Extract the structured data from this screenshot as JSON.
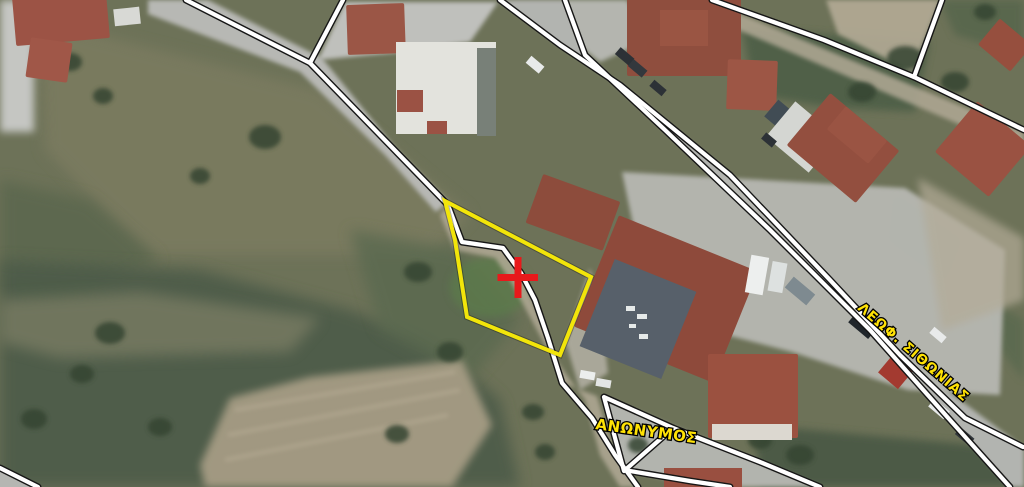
{
  "map": {
    "streets": [
      {
        "name": "ΑΝΩΝΥΜΟΣ",
        "transform": "translate(595,429) rotate(8)"
      },
      {
        "name": "ΛΕΩΦ. ΣΙΘΩΝΙΑΣ",
        "transform": "translate(857,309) rotate(41)"
      }
    ],
    "parcel": {
      "points": "445,201 591,277 560,355 467,317 455,240",
      "outline_color": "#F2E50A"
    },
    "marker": {
      "path": "M497.5,277.5 L538,277.5 M518,257 L518,298",
      "color": "#E8191B"
    },
    "styles": {
      "label_fill": "#FFE205",
      "label_stroke": "#000000",
      "boundary_line": "#FFFFFF",
      "boundary_casing": "#161616",
      "road_surface": "#B2B4B0",
      "field_olive": "#7C7C60",
      "field_dark_green": "#4E5C48",
      "field_beige": "#A69C84",
      "roof_terracotta": "#9A5242",
      "roof_dark": "#57606A"
    }
  }
}
